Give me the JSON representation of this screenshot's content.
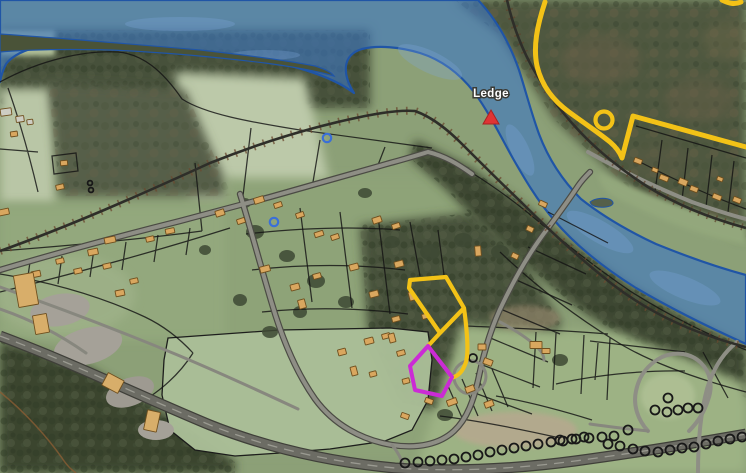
{
  "map": {
    "labels": [
      {
        "text": "Ledge",
        "transform": "translate(491,97)"
      }
    ]
  },
  "markers": {
    "ledge_triangle": {
      "transform": "translate(491,118)"
    },
    "yellow_ring": {
      "transform": "translate(604,120)"
    },
    "blue_rings": [
      [
        274,
        222
      ],
      [
        327,
        138
      ]
    ]
  },
  "features": {
    "water_overlay": {
      "d": "M342,0 L478,0 C497,20 510,44 519,70 C526,92 531,112 539,134 C548,158 562,180 581,199 C600,214 626,230 656,244 C688,257 716,267 746,275 L746,344 C706,326 670,308 636,288 C604,268 576,246 554,220 C537,200 524,178 511,155 C499,133 488,111 474,92 C460,74 442,60 420,53 C400,47 378,45 362,49 C352,52 347,58 346,66 C345,74 348,84 354,93 C337,80 310,70 275,62 C240,55 195,50 150,47 C110,45 70,44 40,47 C25,49 12,56 6,64 C3,70 1,76 0,82 L0,0 Z"
    },
    "river_island_1": {
      "d": "M0,34 C60,38 130,44 200,50 C245,55 285,60 315,66 C325,69 331,72 334,76 C320,72 295,67 265,63 C215,57 160,52 110,50 C70,49 35,49 0,52 Z"
    },
    "river_island_2": {
      "d": "M590,202 C595,198 605,197 611,200 C615,203 613,206 606,207 C597,208 591,206 590,202 Z"
    },
    "yellow_route": {
      "d": "M545,2 C537,26 533,47 537,66 C542,87 554,101 569,112 C584,123 599,133 610,142 C616,147 620,153 622,158 L633,116 L746,147 M722,0 C728,3 734,5 741,2"
    },
    "yellow_parcel": {
      "d": "M410,280 L446,277 L464,308 L440,333 L409,288 Z M464,308 C467,330 469,351 466,362 C463,371 459,376 451,378 M440,333 L428,346"
    },
    "magenta_parcel": {
      "points": "428,346 452,377 442,396 415,390 410,366"
    },
    "buildings": [
      [
        6,
        112,
        11,
        7,
        -8,
        "#CDCDC3"
      ],
      [
        20,
        119,
        8,
        6,
        -8,
        "#CDCDC3"
      ],
      [
        30,
        122,
        6,
        5,
        -8,
        "#CDCDC3"
      ],
      [
        14,
        134,
        7,
        5,
        -8
      ],
      [
        64,
        163,
        7,
        5,
        -5
      ],
      [
        4,
        212,
        10,
        6,
        -12
      ],
      [
        36,
        274,
        9,
        6,
        -12
      ],
      [
        60,
        187,
        8,
        5,
        -12
      ],
      [
        93,
        252,
        10,
        6,
        -12
      ],
      [
        110,
        240,
        11,
        6,
        -12
      ],
      [
        78,
        271,
        8,
        5,
        -12
      ],
      [
        107,
        266,
        8,
        5,
        -12
      ],
      [
        120,
        293,
        9,
        6,
        -12
      ],
      [
        134,
        281,
        8,
        5,
        -12
      ],
      [
        150,
        239,
        8,
        5,
        -12
      ],
      [
        170,
        231,
        9,
        5,
        -12
      ],
      [
        60,
        261,
        8,
        5,
        -12
      ],
      [
        220,
        213,
        9,
        6,
        -18
      ],
      [
        241,
        221,
        8,
        5,
        -18
      ],
      [
        259,
        200,
        10,
        6,
        -18
      ],
      [
        278,
        205,
        8,
        5,
        -18
      ],
      [
        300,
        215,
        8,
        5,
        -18
      ],
      [
        319,
        234,
        9,
        5,
        -18
      ],
      [
        335,
        237,
        8,
        5,
        -18
      ],
      [
        377,
        220,
        9,
        6,
        -18
      ],
      [
        396,
        226,
        8,
        5,
        -18
      ],
      [
        265,
        269,
        10,
        6,
        -15
      ],
      [
        295,
        287,
        9,
        6,
        -15
      ],
      [
        302,
        304,
        7,
        9,
        -15
      ],
      [
        317,
        276,
        8,
        5,
        -15
      ],
      [
        354,
        267,
        9,
        6,
        -15
      ],
      [
        374,
        294,
        9,
        6,
        -15
      ],
      [
        399,
        264,
        9,
        6,
        -15
      ],
      [
        412,
        296,
        6,
        9,
        -15
      ],
      [
        426,
        316,
        8,
        5,
        -15
      ],
      [
        396,
        319,
        8,
        5,
        -15
      ],
      [
        386,
        336,
        8,
        5,
        -15
      ],
      [
        342,
        352,
        8,
        6,
        -15
      ],
      [
        354,
        371,
        6,
        9,
        -15
      ],
      [
        369,
        341,
        9,
        6,
        -15
      ],
      [
        373,
        374,
        7,
        5,
        -15
      ],
      [
        392,
        338,
        6,
        9,
        -15
      ],
      [
        401,
        353,
        8,
        5,
        -15
      ],
      [
        406,
        381,
        7,
        5,
        -15
      ],
      [
        405,
        416,
        8,
        5,
        20
      ],
      [
        429,
        401,
        8,
        5,
        20
      ],
      [
        452,
        402,
        10,
        6,
        -20
      ],
      [
        470,
        389,
        9,
        6,
        -20
      ],
      [
        489,
        404,
        9,
        6,
        -20
      ],
      [
        478,
        251,
        6,
        10,
        -5
      ],
      [
        482,
        347,
        8,
        6,
        0
      ],
      [
        488,
        362,
        9,
        6,
        20
      ],
      [
        536,
        345,
        12,
        7,
        0
      ],
      [
        546,
        351,
        8,
        5,
        0
      ],
      [
        543,
        204,
        8,
        5,
        25
      ],
      [
        530,
        229,
        7,
        5,
        25
      ],
      [
        515,
        256,
        7,
        5,
        25
      ],
      [
        638,
        161,
        8,
        5,
        22
      ],
      [
        664,
        178,
        9,
        5,
        22
      ],
      [
        683,
        182,
        9,
        6,
        22
      ],
      [
        694,
        189,
        8,
        5,
        22
      ],
      [
        717,
        197,
        9,
        5,
        22
      ],
      [
        737,
        200,
        8,
        5,
        22
      ],
      [
        720,
        179,
        6,
        4,
        22
      ],
      [
        655,
        170,
        6,
        4,
        22
      ],
      [
        26,
        290,
        20,
        32,
        -10,
        "#D8AE6A"
      ],
      [
        41,
        324,
        14,
        19,
        -10,
        "#D8AE6A"
      ],
      [
        113,
        383,
        18,
        14,
        28,
        "#D8AE6A"
      ],
      [
        152,
        421,
        13,
        20,
        12,
        "#D8AE6A"
      ]
    ],
    "orchard_circles": [
      [
        405,
        463
      ],
      [
        418,
        462
      ],
      [
        430,
        461
      ],
      [
        442,
        460
      ],
      [
        454,
        459
      ],
      [
        466,
        457
      ],
      [
        478,
        455
      ],
      [
        490,
        452
      ],
      [
        502,
        450
      ],
      [
        514,
        448
      ],
      [
        526,
        446
      ],
      [
        538,
        444
      ],
      [
        551,
        442
      ],
      [
        563,
        441
      ],
      [
        576,
        439
      ],
      [
        589,
        438
      ],
      [
        602,
        437
      ],
      [
        614,
        436
      ],
      [
        628,
        430
      ],
      [
        608,
        444
      ],
      [
        620,
        446
      ],
      [
        633,
        449
      ],
      [
        645,
        451
      ],
      [
        658,
        452
      ],
      [
        670,
        450
      ],
      [
        682,
        448
      ],
      [
        694,
        447
      ],
      [
        706,
        444
      ],
      [
        718,
        441
      ],
      [
        730,
        439
      ],
      [
        742,
        437
      ],
      [
        655,
        410
      ],
      [
        667,
        412
      ],
      [
        678,
        410
      ],
      [
        688,
        408
      ],
      [
        698,
        408
      ],
      [
        668,
        398
      ],
      [
        560,
        440
      ],
      [
        572,
        439
      ],
      [
        584,
        437
      ],
      [
        473,
        358,
        4
      ],
      [
        90,
        183,
        2.4
      ],
      [
        91,
        190,
        2.4
      ]
    ]
  },
  "colors": {
    "water_fill": "#3E78C2",
    "water_edge": "#2055A6",
    "route_yellow": "#F3C217",
    "parcel_magenta": "#CB2BD5",
    "marker_red": "#E03434",
    "ring_blue": "#3A6FD8",
    "building_fill": "#D9A75F",
    "label_text": "#FFFFFF"
  }
}
